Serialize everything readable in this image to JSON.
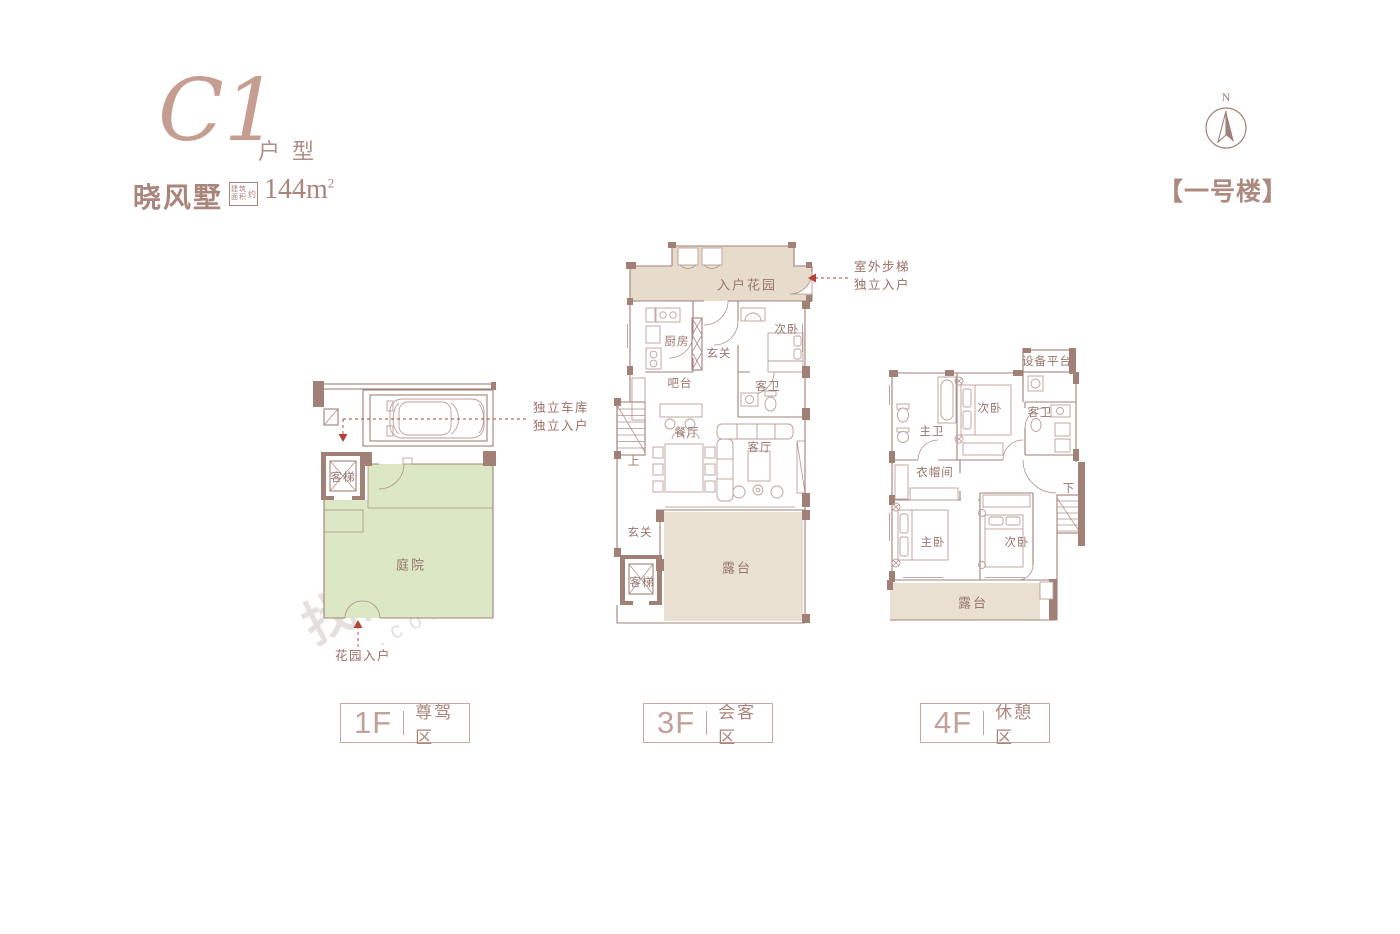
{
  "header": {
    "unit_code": "C1",
    "unit_suffix": "户型",
    "project_name": "晓风墅",
    "area_label_top": "建筑",
    "area_label_bottom": "面积",
    "area_label_about": "约",
    "area_value": "144m",
    "area_sup": "2"
  },
  "compass": {
    "letter": "N"
  },
  "building_label": "【一号楼】",
  "watermark": {
    "text": "找房",
    "suffix": ".com"
  },
  "plans": {
    "f1": {
      "floor": "1F",
      "zone": "尊驾区",
      "rooms": {
        "elevator": "客梯",
        "courtyard": "庭院"
      },
      "notes": {
        "garage_line1": "独立车库",
        "garage_line2": "独立入户",
        "garden_entry": "花园入户"
      }
    },
    "f3": {
      "floor": "3F",
      "zone": "会客区",
      "rooms": {
        "entry_garden": "入户花园",
        "kitchen": "厨房",
        "foyer": "玄关",
        "bedroom2": "次卧",
        "bar": "吧台",
        "guest_bath": "客卫",
        "dining": "餐厅",
        "living": "客厅",
        "foyer_lower": "玄关",
        "elevator": "客梯",
        "terrace": "露台",
        "stairs_up": "上"
      },
      "notes": {
        "outdoor_line1": "室外步梯",
        "outdoor_line2": "独立入户"
      }
    },
    "f4": {
      "floor": "4F",
      "zone": "休憩区",
      "rooms": {
        "equipment_platform": "设备平台",
        "bedroom2_upper": "次卧",
        "master_bath": "主卫",
        "guest_bath": "客卫",
        "cloakroom": "衣帽间",
        "master_bedroom": "主卧",
        "bedroom2_lower": "次卧",
        "terrace": "露台",
        "stairs_down": "下"
      }
    }
  },
  "colors": {
    "accent": "#a08077",
    "courtyard_green": "#dbe7c5",
    "terrace_beige": "#e9e0d1",
    "entry_garden_beige": "#e7dccb",
    "arrow_red": "#b04438"
  }
}
